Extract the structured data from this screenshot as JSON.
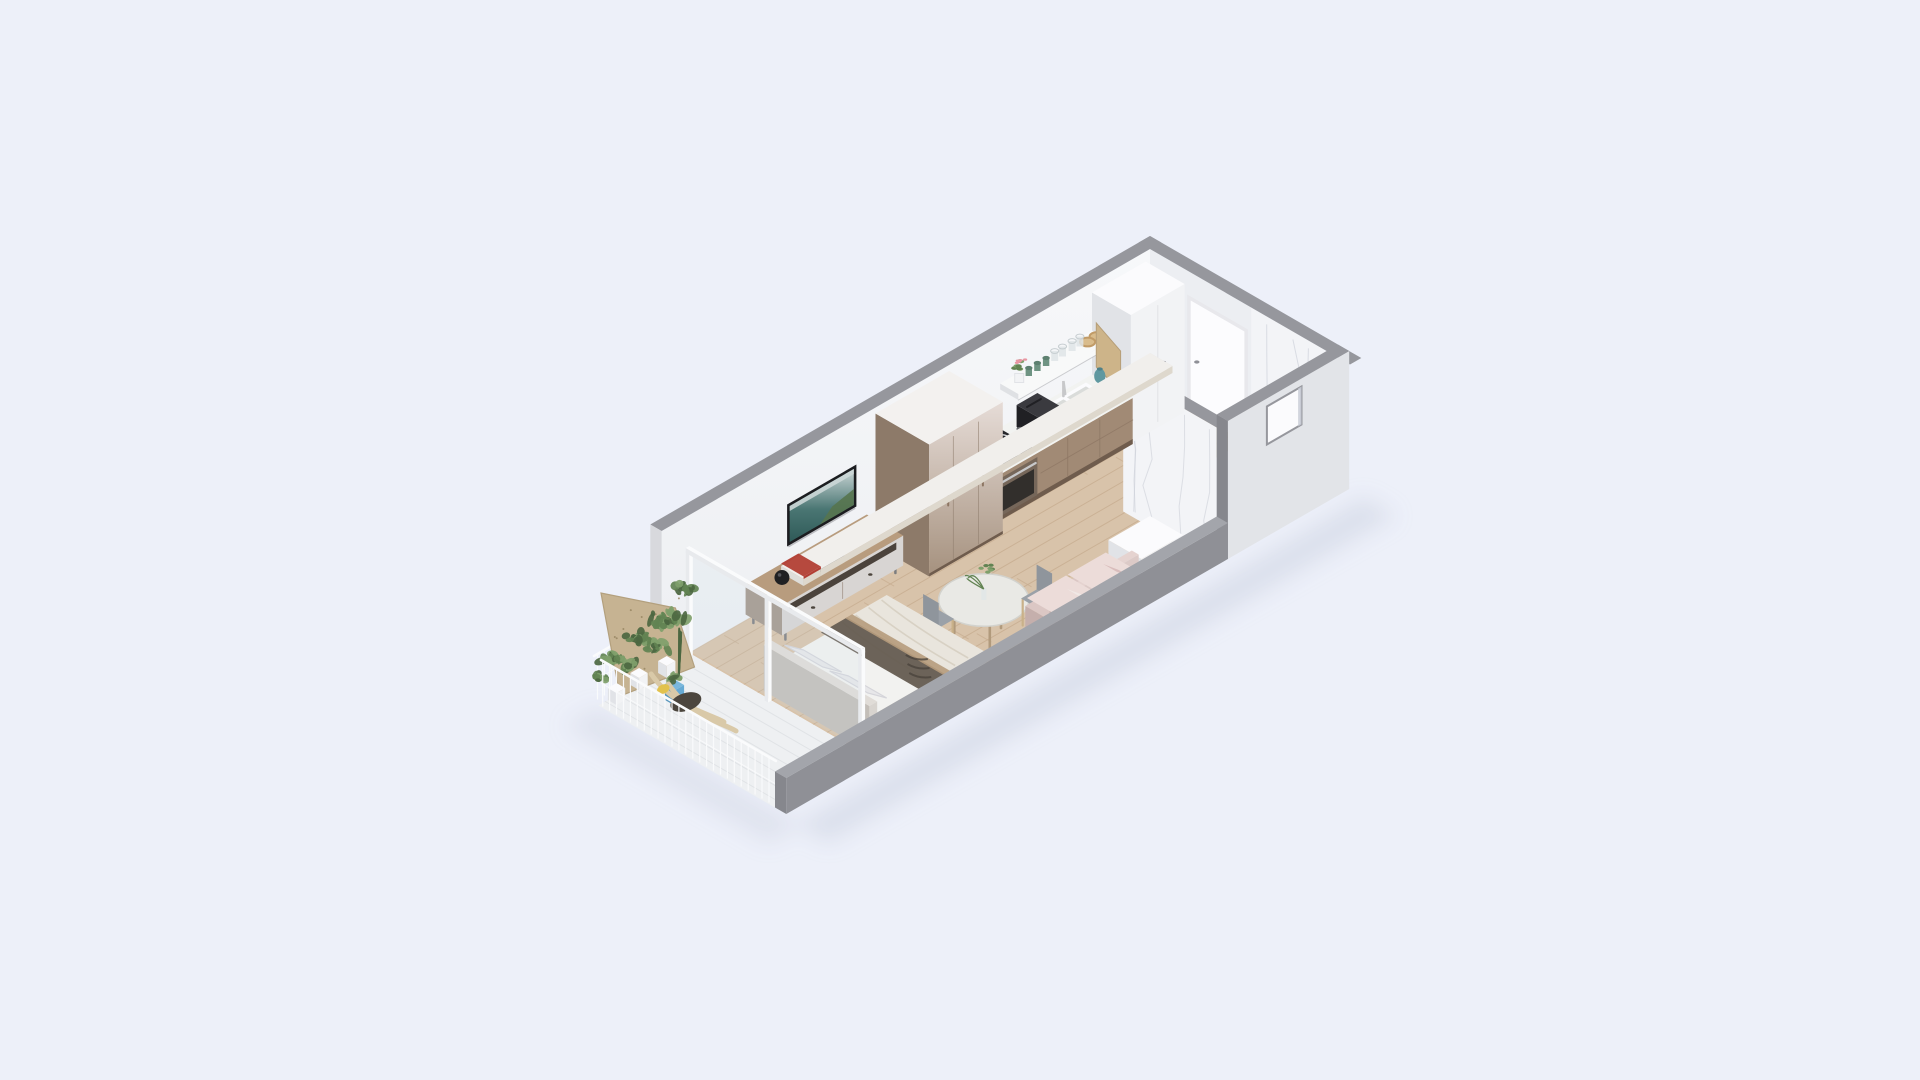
{
  "scene": {
    "description": "Isometric 3D cutaway floor-plan render of a small studio apartment on a plain pale background",
    "rooms": [
      {
        "name": "living-bedroom",
        "furniture": [
          "double-bed",
          "headboard",
          "pillows",
          "duvet",
          "throw-blanket",
          "tv",
          "tv-console",
          "speaker-vase",
          "book-stack",
          "record-deck",
          "dining-table",
          "table-vase",
          "dining-chair-1",
          "dining-chair-2",
          "sofa",
          "sofa-pillows",
          "storage-desk",
          "wardrobe-unit"
        ]
      },
      {
        "name": "kitchen",
        "furniture": [
          "tall-white-cabinet",
          "kitchen-counter",
          "sink",
          "faucet",
          "induction-cooktop",
          "built-in-oven",
          "toaster",
          "open-shelf",
          "glasses",
          "green-cups",
          "amber-bowls",
          "flower-pot",
          "cutting-board",
          "teal-jug"
        ]
      },
      {
        "name": "entry-bathroom",
        "furniture": [
          "entry-door",
          "door-handle",
          "marble-wall",
          "bathroom-partition",
          "window-niche"
        ]
      },
      {
        "name": "balcony",
        "furniture": [
          "glass-partition",
          "plywood-panel",
          "balcony-plants",
          "plant-pots",
          "blue-pot",
          "lounge-chair",
          "yellow-cushion",
          "railing"
        ]
      }
    ],
    "elements": [
      "apartment-shadow",
      "wood-floor",
      "bathroom-floor",
      "balcony-floor",
      "back-wall",
      "end-wall",
      "entry-door",
      "marble-wall",
      "bathroom-partition",
      "front-wall-full",
      "window-niche",
      "front-wall-band",
      "tall-white-cabinet",
      "kitchen-counter",
      "kitchen-shelf",
      "sink",
      "cooktop",
      "oven",
      "toaster",
      "wardrobe-unit",
      "tv",
      "tv-console",
      "dining-set",
      "storage-desk",
      "bed",
      "sofa",
      "glass-partition",
      "balcony"
    ]
  },
  "palette": {
    "bg": "#edf0f9",
    "shadow": "#c2cadc",
    "wood": "#d8c3aa",
    "woodLine": "#c7ad90",
    "bathFloor": "#e9eaee",
    "balconyFloor": "#eef0f2",
    "tileLine": "#dfe2e5",
    "wallTop": "#f7f8fa",
    "wallBot": "#edeff2",
    "wallShade": "#eceef2",
    "cap": "#96979d",
    "capDark": "#86878d",
    "wallEnd": "#d8d9dd",
    "bandTop": "#a3a5ab",
    "bandOut": "#8f9096",
    "eWall": "#e2e4e8",
    "marble": "#f3f4f7",
    "vein": "#c8ccd6",
    "door": "#fcfcfe",
    "doorFrame": "#e8e8ec",
    "handle": "#8f9097",
    "whiteT": "#fbfbfd",
    "whiteF": "#f2f3f5",
    "whiteS": "#e1e3e7",
    "cTop": "#f2f3f1",
    "cFront": "#a18a75",
    "cSide": "#8a7361",
    "cKick": "#6f5c4d",
    "seam": "#8d7663",
    "shelf": "#f8f9f9",
    "shelfEdge": "#dfe1e4",
    "cooktop": "#26262a",
    "ring": "#d4d6d8",
    "ovenF": "#76675a",
    "ovenG": "#322f2c",
    "steel": "#c7c8ca",
    "toaster": "#2b2b2f",
    "toasterT": "#3a3a3f",
    "toasterS": "#202024",
    "basin": "#dadcda",
    "drain": "#66686a",
    "unitT": "#f3f1ef",
    "unitA": "#e6dcd7",
    "unitB": "#a5917e",
    "unitSide": "#8d7a69",
    "unitSeam": "#8f7d6d",
    "tvFrame": "#1c1d20",
    "tvSky": "#ccd7d7",
    "tvSeaA": "#4a7673",
    "tvSeaB": "#2f5a58",
    "tvLand": "#56744e",
    "conTop": "#b89c7e",
    "conBody": "#d8d5d3",
    "conSlot": "#4b433c",
    "conSide": "#a3958a",
    "leg": "#7c7d80",
    "deck": "#3b3835",
    "bookW": "#f1efec",
    "bookR": "#b23f35",
    "vase": "#202022",
    "vaseHi": "#55555a",
    "tTop": "#e9e9e5",
    "tRim": "#d2d2cd",
    "tLeg": "#b19a7c",
    "chSeat": "#9ba1a8",
    "chBack": "#8f959c",
    "chLeg": "#c9b189",
    "bedT": "#d8c2a2",
    "bedF": "#cdb493",
    "bedS": "#b89f7f",
    "matT": "#f2f2f0",
    "matF": "#e7e7e4",
    "matS": "#deddd9",
    "duvet": "#e9e5dd",
    "duvetD": "#ded8cd",
    "fold": "#d5cec0",
    "pillow": "#e7e7e9",
    "pillowE": "#d5d5da",
    "hbT": "#e0dcd7",
    "hbF": "#d8d4cf",
    "hbS": "#c3beb8",
    "thDark": "#655c51",
    "thLine": "#4b443c",
    "thTan": "#b69b7c",
    "sofaT": "#dbc7c4",
    "sofaF": "#d3bfbc",
    "sofaS": "#c5afac",
    "sbT": "#e5d3d0",
    "sbF": "#dccac7",
    "cushT": "#ecdcd9",
    "cushF": "#e3d3d0",
    "spA": "#d9bdbc",
    "spB": "#f0e8e5",
    "rail": "#fafbfc",
    "railS": "#e8eaed",
    "glass": "#cfe0ea",
    "ply": "#c6b392",
    "plyEdge": "#b3a07e",
    "plyDot": "#93825f",
    "pDark": "#4c6741",
    "pMid": "#628352",
    "pLight": "#7fa06b",
    "potBT": "#7ab7dc",
    "potBF": "#66aad4",
    "potBS": "#5796bd",
    "jug": "#5f98a0",
    "jugD": "#4f8088",
    "boardC": "#cdb489",
    "boardE": "#b69e78",
    "amber": "#c19b67",
    "amberF": "#d9bc8c",
    "cupG": "#6f9483",
    "cupGD": "#5d8070",
    "glassC": "#dfe5e7",
    "glassE": "#c6cdd0",
    "pink": "#e896a2",
    "shell": "#d9c9a8",
    "seatD": "#4c463e",
    "yellow": "#e2c24d"
  }
}
